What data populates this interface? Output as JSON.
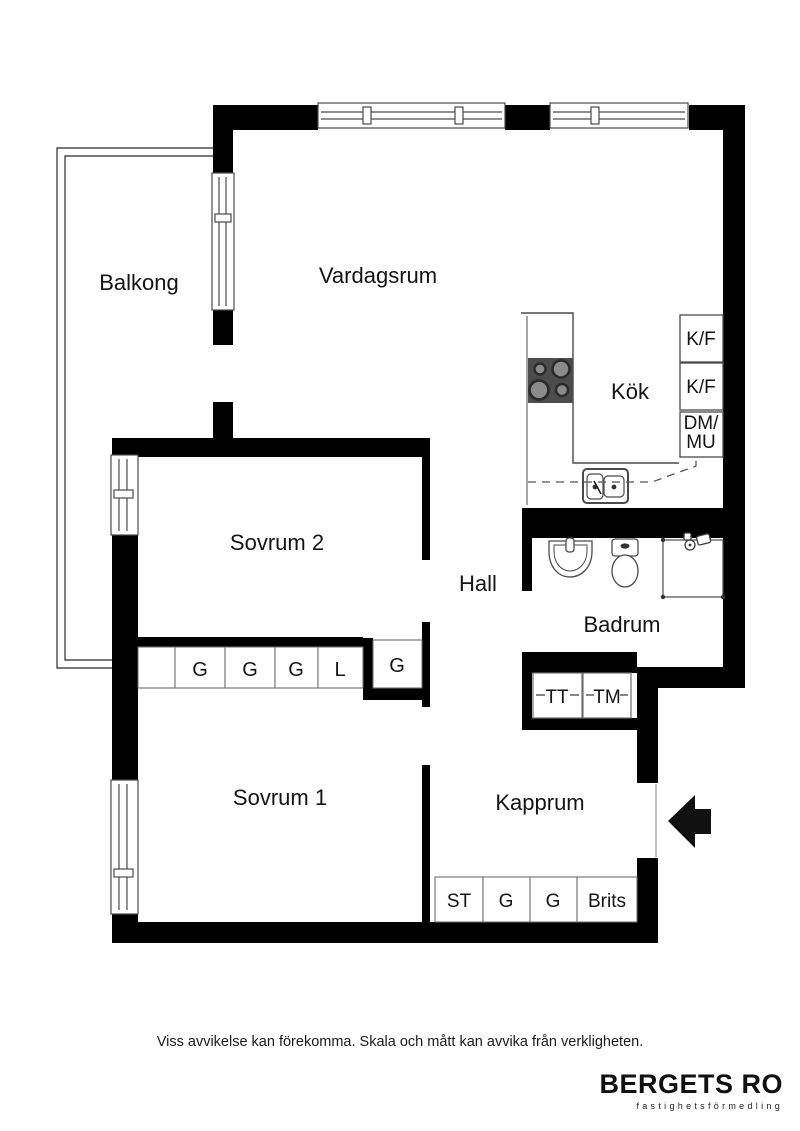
{
  "plan": {
    "rooms": {
      "balkong": "Balkong",
      "vardagsrum": "Vardagsrum",
      "kok": "Kök",
      "sovrum2": "Sovrum 2",
      "hall": "Hall",
      "badrum": "Badrum",
      "sovrum1": "Sovrum 1",
      "kapprum": "Kapprum"
    },
    "kitchen_units": {
      "kf1": "K/F",
      "kf2": "K/F",
      "dm_line1": "DM/",
      "dm_line2": "MU"
    },
    "wardrobes_sovrum2": [
      "G",
      "G",
      "G",
      "L"
    ],
    "hall_closet": "G",
    "laundry": {
      "tt": "TT",
      "tm": "TM"
    },
    "kapprum_units": [
      "ST",
      "G",
      "G",
      "Brits"
    ],
    "colors": {
      "wall": "#000000",
      "stove": "#4c4c4c",
      "thin_line": "#4a4a4a",
      "cell_border": "#6e6e6e"
    }
  },
  "footer": {
    "disclaimer": "Viss avvikelse kan förekomma. Skala och mått kan avvika från verkligheten.",
    "brand": "BERGETS RO",
    "brand_tagline": "fastighetsförmedling"
  }
}
